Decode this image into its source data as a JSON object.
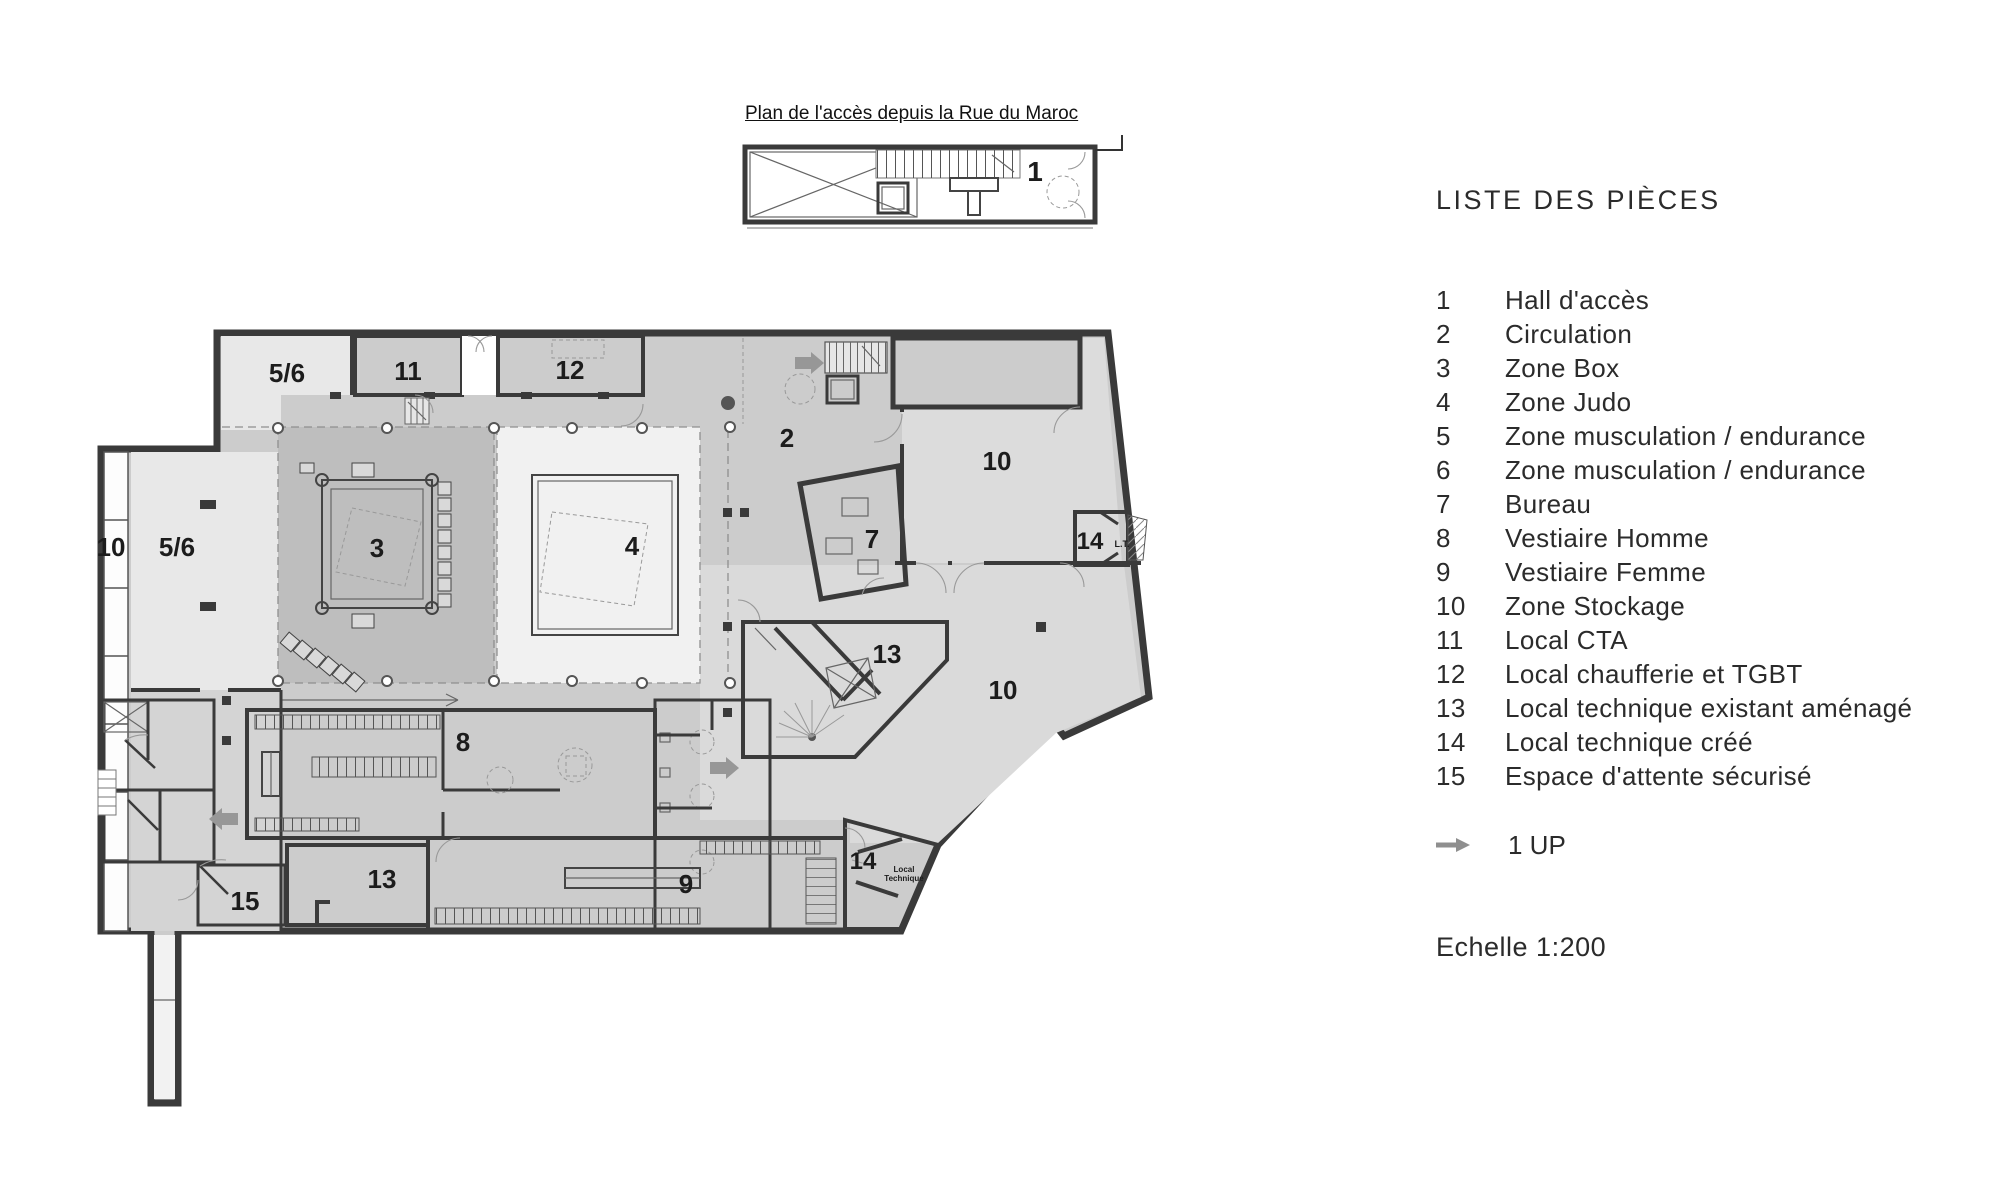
{
  "access_plan": {
    "title": "Plan de l'accès depuis la Rue du Maroc"
  },
  "legend": {
    "header": "LISTE DES PIÈCES",
    "items": [
      {
        "num": "1",
        "label": "Hall d'accès"
      },
      {
        "num": "2",
        "label": "Circulation"
      },
      {
        "num": "3",
        "label": "Zone Box"
      },
      {
        "num": "4",
        "label": "Zone Judo"
      },
      {
        "num": "5",
        "label": "Zone musculation / endurance"
      },
      {
        "num": "6",
        "label": "Zone musculation / endurance"
      },
      {
        "num": "7",
        "label": "Bureau"
      },
      {
        "num": "8",
        "label": "Vestiaire Homme"
      },
      {
        "num": "9",
        "label": "Vestiaire Femme"
      },
      {
        "num": "10",
        "label": "Zone Stockage"
      },
      {
        "num": "11",
        "label": "Local CTA"
      },
      {
        "num": "12",
        "label": "Local chaufferie et TGBT"
      },
      {
        "num": "13",
        "label": "Local technique existant aménagé"
      },
      {
        "num": "14",
        "label": "Local technique créé"
      },
      {
        "num": "15",
        "label": "Espace d'attente sécurisé"
      }
    ],
    "up_note": "1 UP",
    "scale": "Echelle 1:200"
  },
  "plan_labels": [
    {
      "text": "5/6",
      "x": 287,
      "y": 382,
      "s": 26
    },
    {
      "text": "11",
      "x": 408,
      "y": 380,
      "s": 26
    },
    {
      "text": "12",
      "x": 570,
      "y": 379,
      "s": 26
    },
    {
      "text": "2",
      "x": 787,
      "y": 447,
      "s": 26
    },
    {
      "text": "10",
      "x": 997,
      "y": 470,
      "s": 26
    },
    {
      "text": "10",
      "x": 111,
      "y": 556,
      "s": 26
    },
    {
      "text": "5/6",
      "x": 177,
      "y": 556,
      "s": 26
    },
    {
      "text": "3",
      "x": 377,
      "y": 557,
      "s": 26
    },
    {
      "text": "4",
      "x": 632,
      "y": 555,
      "s": 26
    },
    {
      "text": "7",
      "x": 872,
      "y": 548,
      "s": 26
    },
    {
      "text": "14",
      "x": 1090,
      "y": 549,
      "s": 24
    },
    {
      "text": "L.T.",
      "x": 1122,
      "y": 547,
      "s": 9
    },
    {
      "text": "13",
      "x": 887,
      "y": 663,
      "s": 26
    },
    {
      "text": "10",
      "x": 1003,
      "y": 699,
      "s": 26
    },
    {
      "text": "8",
      "x": 463,
      "y": 751,
      "s": 26
    },
    {
      "text": "15",
      "x": 245,
      "y": 910,
      "s": 26
    },
    {
      "text": "13",
      "x": 382,
      "y": 888,
      "s": 26
    },
    {
      "text": "9",
      "x": 686,
      "y": 893,
      "s": 26
    },
    {
      "text": "14",
      "x": 863,
      "y": 869,
      "s": 24
    },
    {
      "text": "Local",
      "x": 904,
      "y": 872,
      "s": 8
    },
    {
      "text": "Technique",
      "x": 904,
      "y": 881,
      "s": 8
    },
    {
      "text": "1",
      "x": 1035,
      "y": 181,
      "s": 28
    }
  ],
  "colors": {
    "wall": "#3a3a3a",
    "floor": "#cccccc",
    "zone_box": "#bebebe",
    "zone_judo": "#f1f1f1",
    "room_light": "#e8e8e8",
    "storage": "#dcdcdc",
    "arrow_gray": "#979797",
    "text": "#2b2b2b"
  }
}
